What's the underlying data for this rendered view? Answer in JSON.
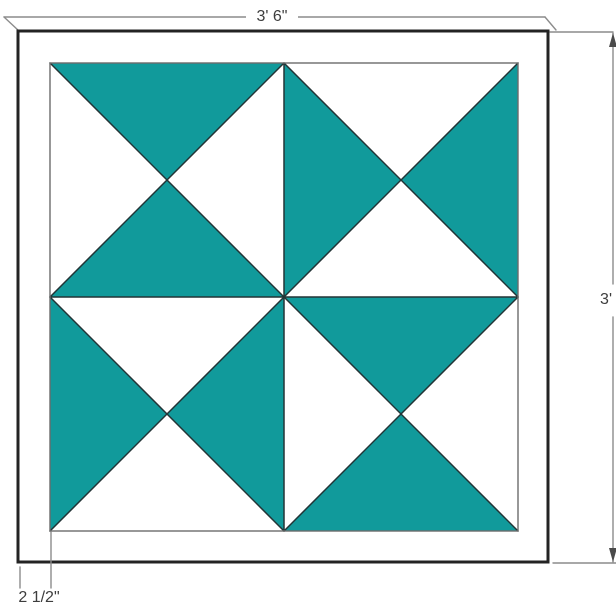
{
  "diagram": {
    "title": "Barn quilt block dimension diagram",
    "labels": {
      "width": "3' 6\"",
      "height": "3'",
      "border_width": "2 1/2\""
    },
    "colors": {
      "teal": "#119a9b",
      "white": "#ffffff",
      "frame_fill": "#ffffff",
      "frame_stroke": "#232323",
      "patch_outline": "#223436",
      "pattern_border": "#6b6b6b",
      "dimension_line": "#8c8c8c",
      "arrow": "#4a4a4a",
      "label_text": "#3d3d3d"
    },
    "pattern": {
      "grid": "2x2",
      "block_style": "hourglass quarter-square triangles",
      "blocks": [
        {
          "position": "top-left",
          "colors": {
            "top": "#119a9b",
            "right": "#ffffff",
            "bottom": "#119a9b",
            "left": "#ffffff"
          }
        },
        {
          "position": "top-right",
          "colors": {
            "top": "#ffffff",
            "right": "#119a9b",
            "bottom": "#ffffff",
            "left": "#119a9b"
          }
        },
        {
          "position": "bottom-left",
          "colors": {
            "top": "#ffffff",
            "right": "#119a9b",
            "bottom": "#ffffff",
            "left": "#119a9b"
          }
        },
        {
          "position": "bottom-right",
          "colors": {
            "top": "#119a9b",
            "right": "#ffffff",
            "bottom": "#119a9b",
            "left": "#ffffff"
          }
        }
      ]
    }
  }
}
